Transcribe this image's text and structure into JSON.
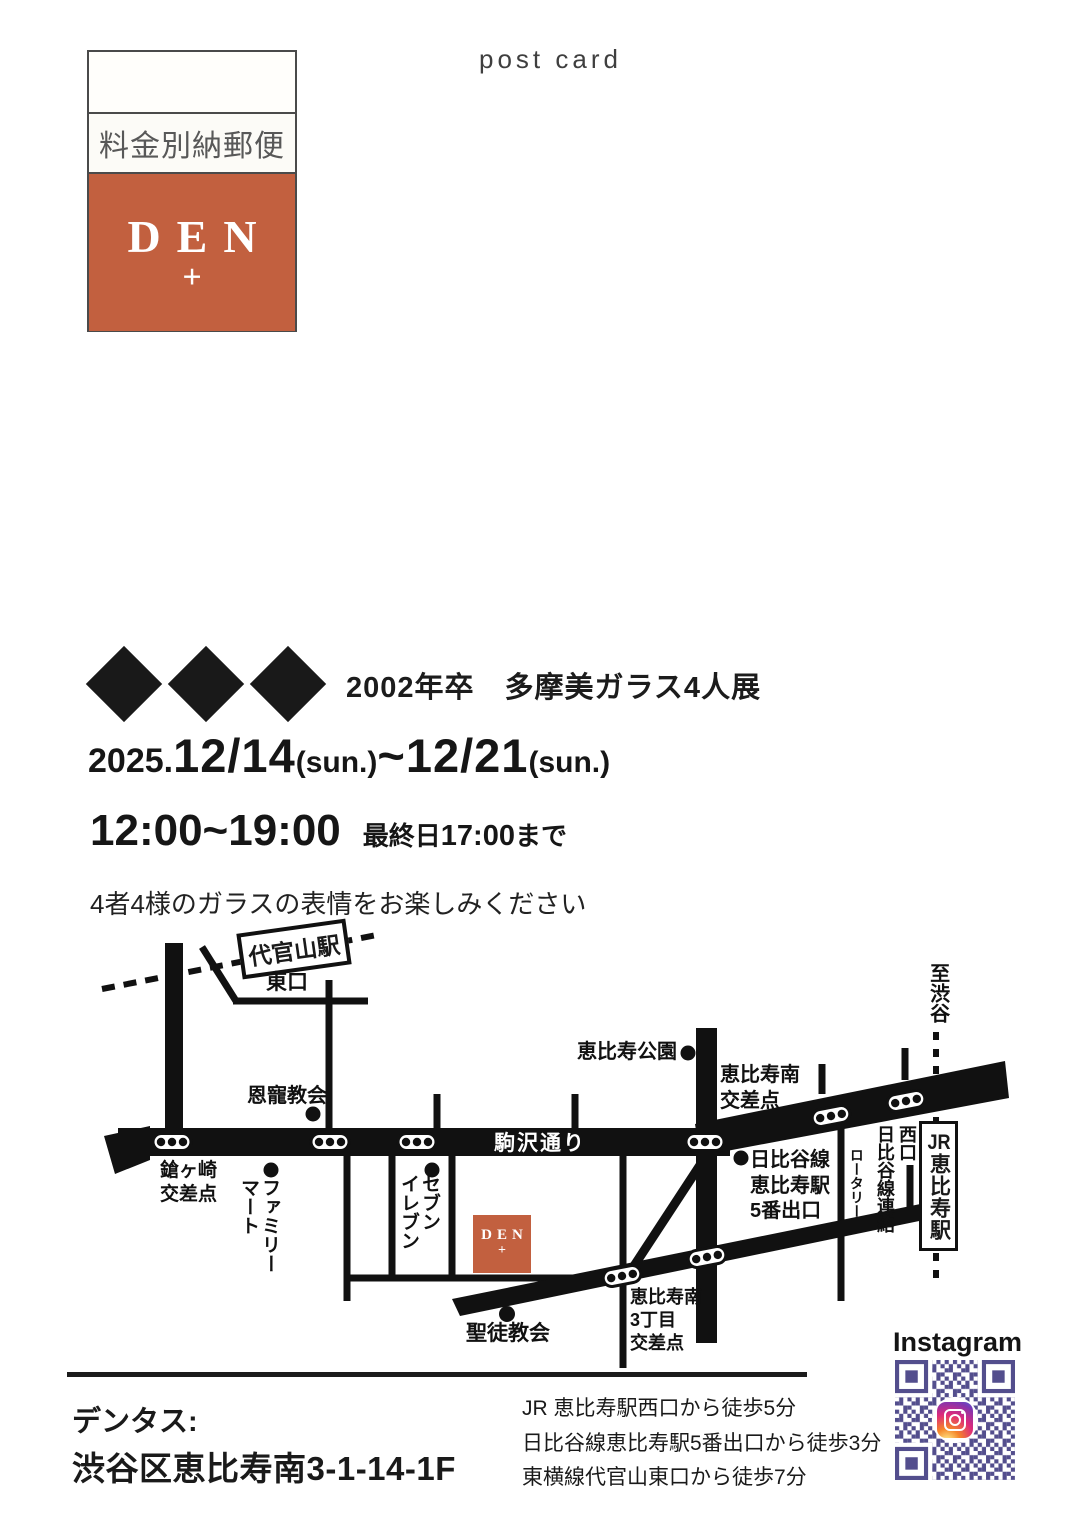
{
  "page": {
    "top_label": "post card"
  },
  "stamp": {
    "postage_label": "料金別納郵便",
    "brand": "DEN",
    "brand_plus": "+"
  },
  "hero": {
    "title": "2002年卒　多摩美ガラス4人展",
    "date_parts": [
      "2025.",
      "12/14",
      "(sun.)",
      "~",
      "12/21",
      "(sun.)"
    ],
    "time_main": "12:00~19:00",
    "time_note_pre": "最終日",
    "time_note_time": "17:00",
    "time_note_post": "まで",
    "tagline": "4者4様のガラスの表情をお楽しみください"
  },
  "map": {
    "daikanyama_station": "代官山駅",
    "east_exit": "東口",
    "onchou_church": "恩寵教会",
    "yarigasaki_crossing": "鎗ヶ崎\n交差点",
    "family_mart": "ファミリー\nマート",
    "seven_eleven": "セブン\nイレブン",
    "komazawa_street": "駒沢通り",
    "ebisu_park": "恵比寿公園",
    "ebisu_minami_crossing": "恵比寿南\n交差点",
    "hibiya_exit": "日比谷線\n恵比寿駅\n5番出口",
    "rotary": "ロータリー",
    "west_exit_link": "西口\n日比谷線連絡",
    "jr_prefix": "JR",
    "jr_station_name": "恵比寿駅",
    "to_shibuya": "至渋谷",
    "sanchome_crossing": "恵比寿南\n3丁目\n交差点",
    "seito_church": "聖徒教会",
    "den_logo": "DEN",
    "den_logo_plus": "+"
  },
  "instagram": {
    "label": "Instagram"
  },
  "footer": {
    "shop_name": "デンタス:",
    "address": "渋谷区恵比寿南3-1-14-1F",
    "access": [
      "JR 恵比寿駅西口から徒歩5分",
      "日比谷線恵比寿駅5番出口から徒歩3分",
      "東横線代官山東口から徒歩7分"
    ]
  },
  "colors": {
    "accent_orange": "#c2603f",
    "qr_purple": "#534e8d",
    "ink": "#1a1a1a"
  }
}
